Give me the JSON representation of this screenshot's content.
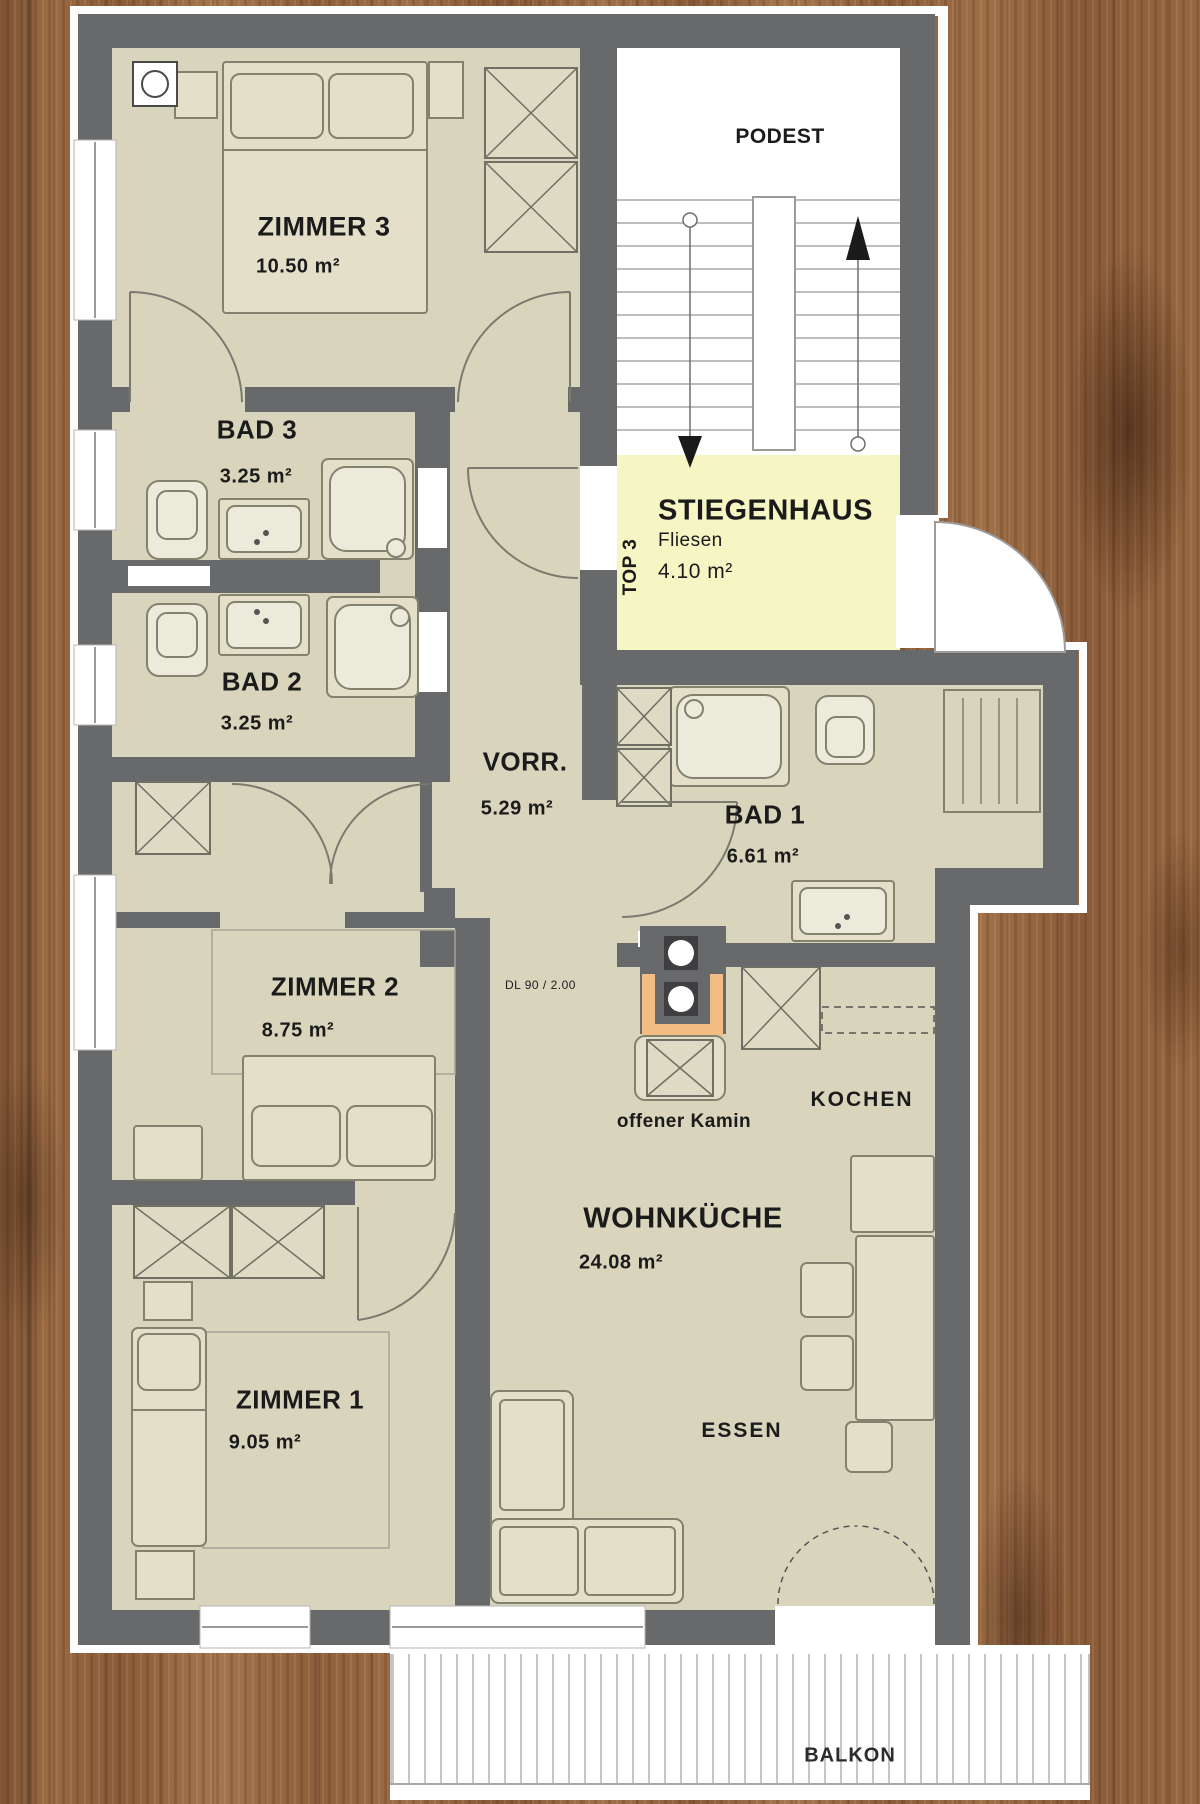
{
  "plan": {
    "rooms": {
      "zimmer3": {
        "name": "ZIMMER 3",
        "area": "10.50 m²"
      },
      "bad3": {
        "name": "BAD 3",
        "area": "3.25 m²"
      },
      "bad2": {
        "name": "BAD 2",
        "area": "3.25 m²"
      },
      "vorraum": {
        "name": "VORR.",
        "area": "5.29 m²"
      },
      "bad1": {
        "name": "BAD 1",
        "area": "6.61 m²"
      },
      "zimmer2": {
        "name": "ZIMMER 2",
        "area": "8.75 m²"
      },
      "zimmer1": {
        "name": "ZIMMER 1",
        "area": "9.05 m²"
      },
      "wohnkueche": {
        "name": "WOHNKÜCHE",
        "area": "24.08 m²"
      }
    },
    "stairwell": {
      "name": "STIEGENHAUS",
      "finish": "Fliesen",
      "area": "4.10 m²",
      "landing": "PODEST",
      "unit": "TOP 3"
    },
    "labels": {
      "kochen": "KOCHEN",
      "essen": "ESSEN",
      "balkon": "BALKON",
      "kamin": "offener Kamin",
      "door_spec": "DL 90 / 2.00"
    },
    "icons": {
      "stairs_up": "up-arrow-icon",
      "stairs_down": "down-arrow-icon"
    },
    "colors": {
      "wall": "#68696b",
      "floor": "#d9d5bd",
      "furniture": "#e3dfc9",
      "stairwell_floor": "#f6f6c4",
      "accent_orange": "#f2bc83",
      "wood": "#96663f",
      "balcony": "#ffffff"
    }
  }
}
